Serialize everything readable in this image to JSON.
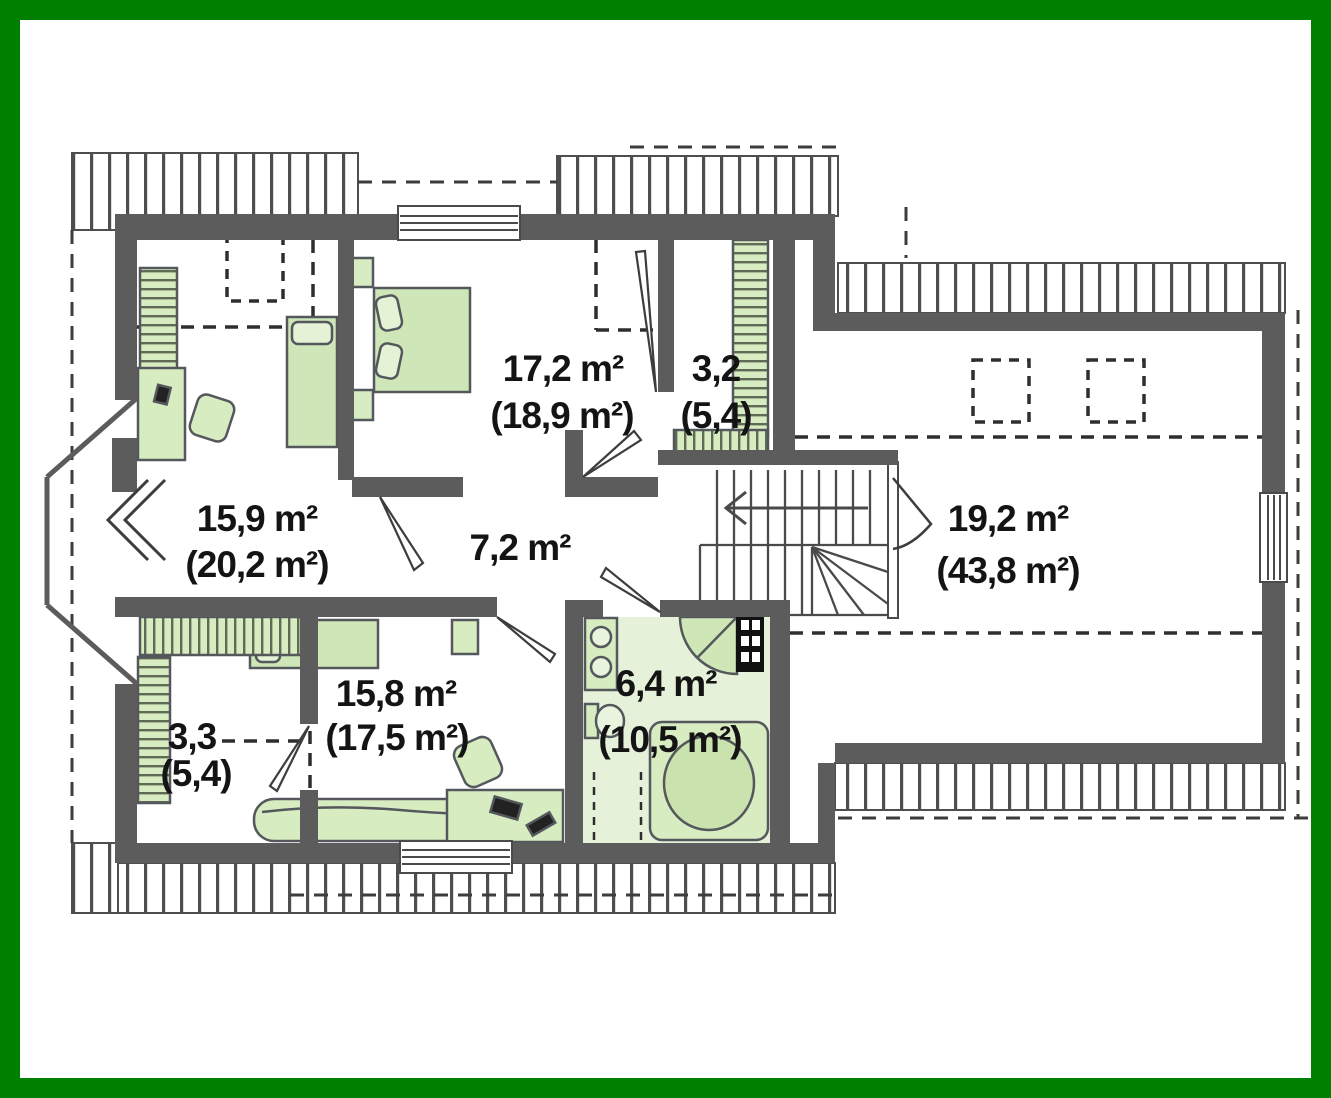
{
  "plan_title": "attic-floor-plan",
  "colors": {
    "frame_green": "#008000",
    "wall_gray": "#5c5c5c",
    "furniture_green": "#d8ecc2",
    "bath_floor_green": "#e6f1da",
    "line_dark": "#3d3d3d"
  },
  "floorplan": {
    "rooms": [
      {
        "id": "bedroom-left",
        "area": "15,9 m²",
        "area_total": "(20,2 m²)"
      },
      {
        "id": "bedroom-top",
        "area": "17,2 m²",
        "area_total": "(18,9 m²)"
      },
      {
        "id": "closet-top",
        "area": "3,2",
        "area_total": "(5,4)"
      },
      {
        "id": "hall",
        "area": "7,2 m²",
        "area_total": ""
      },
      {
        "id": "attic-room",
        "area": "19,2 m²",
        "area_total": "(43,8 m²)"
      },
      {
        "id": "bedroom-bottom",
        "area": "15,8 m²",
        "area_total": "(17,5 m²)"
      },
      {
        "id": "bathroom",
        "area": "6,4 m²",
        "area_total": "(10,5 m²)"
      },
      {
        "id": "closet-bottom",
        "area": "3,3",
        "area_total": "(5,4)"
      }
    ]
  }
}
